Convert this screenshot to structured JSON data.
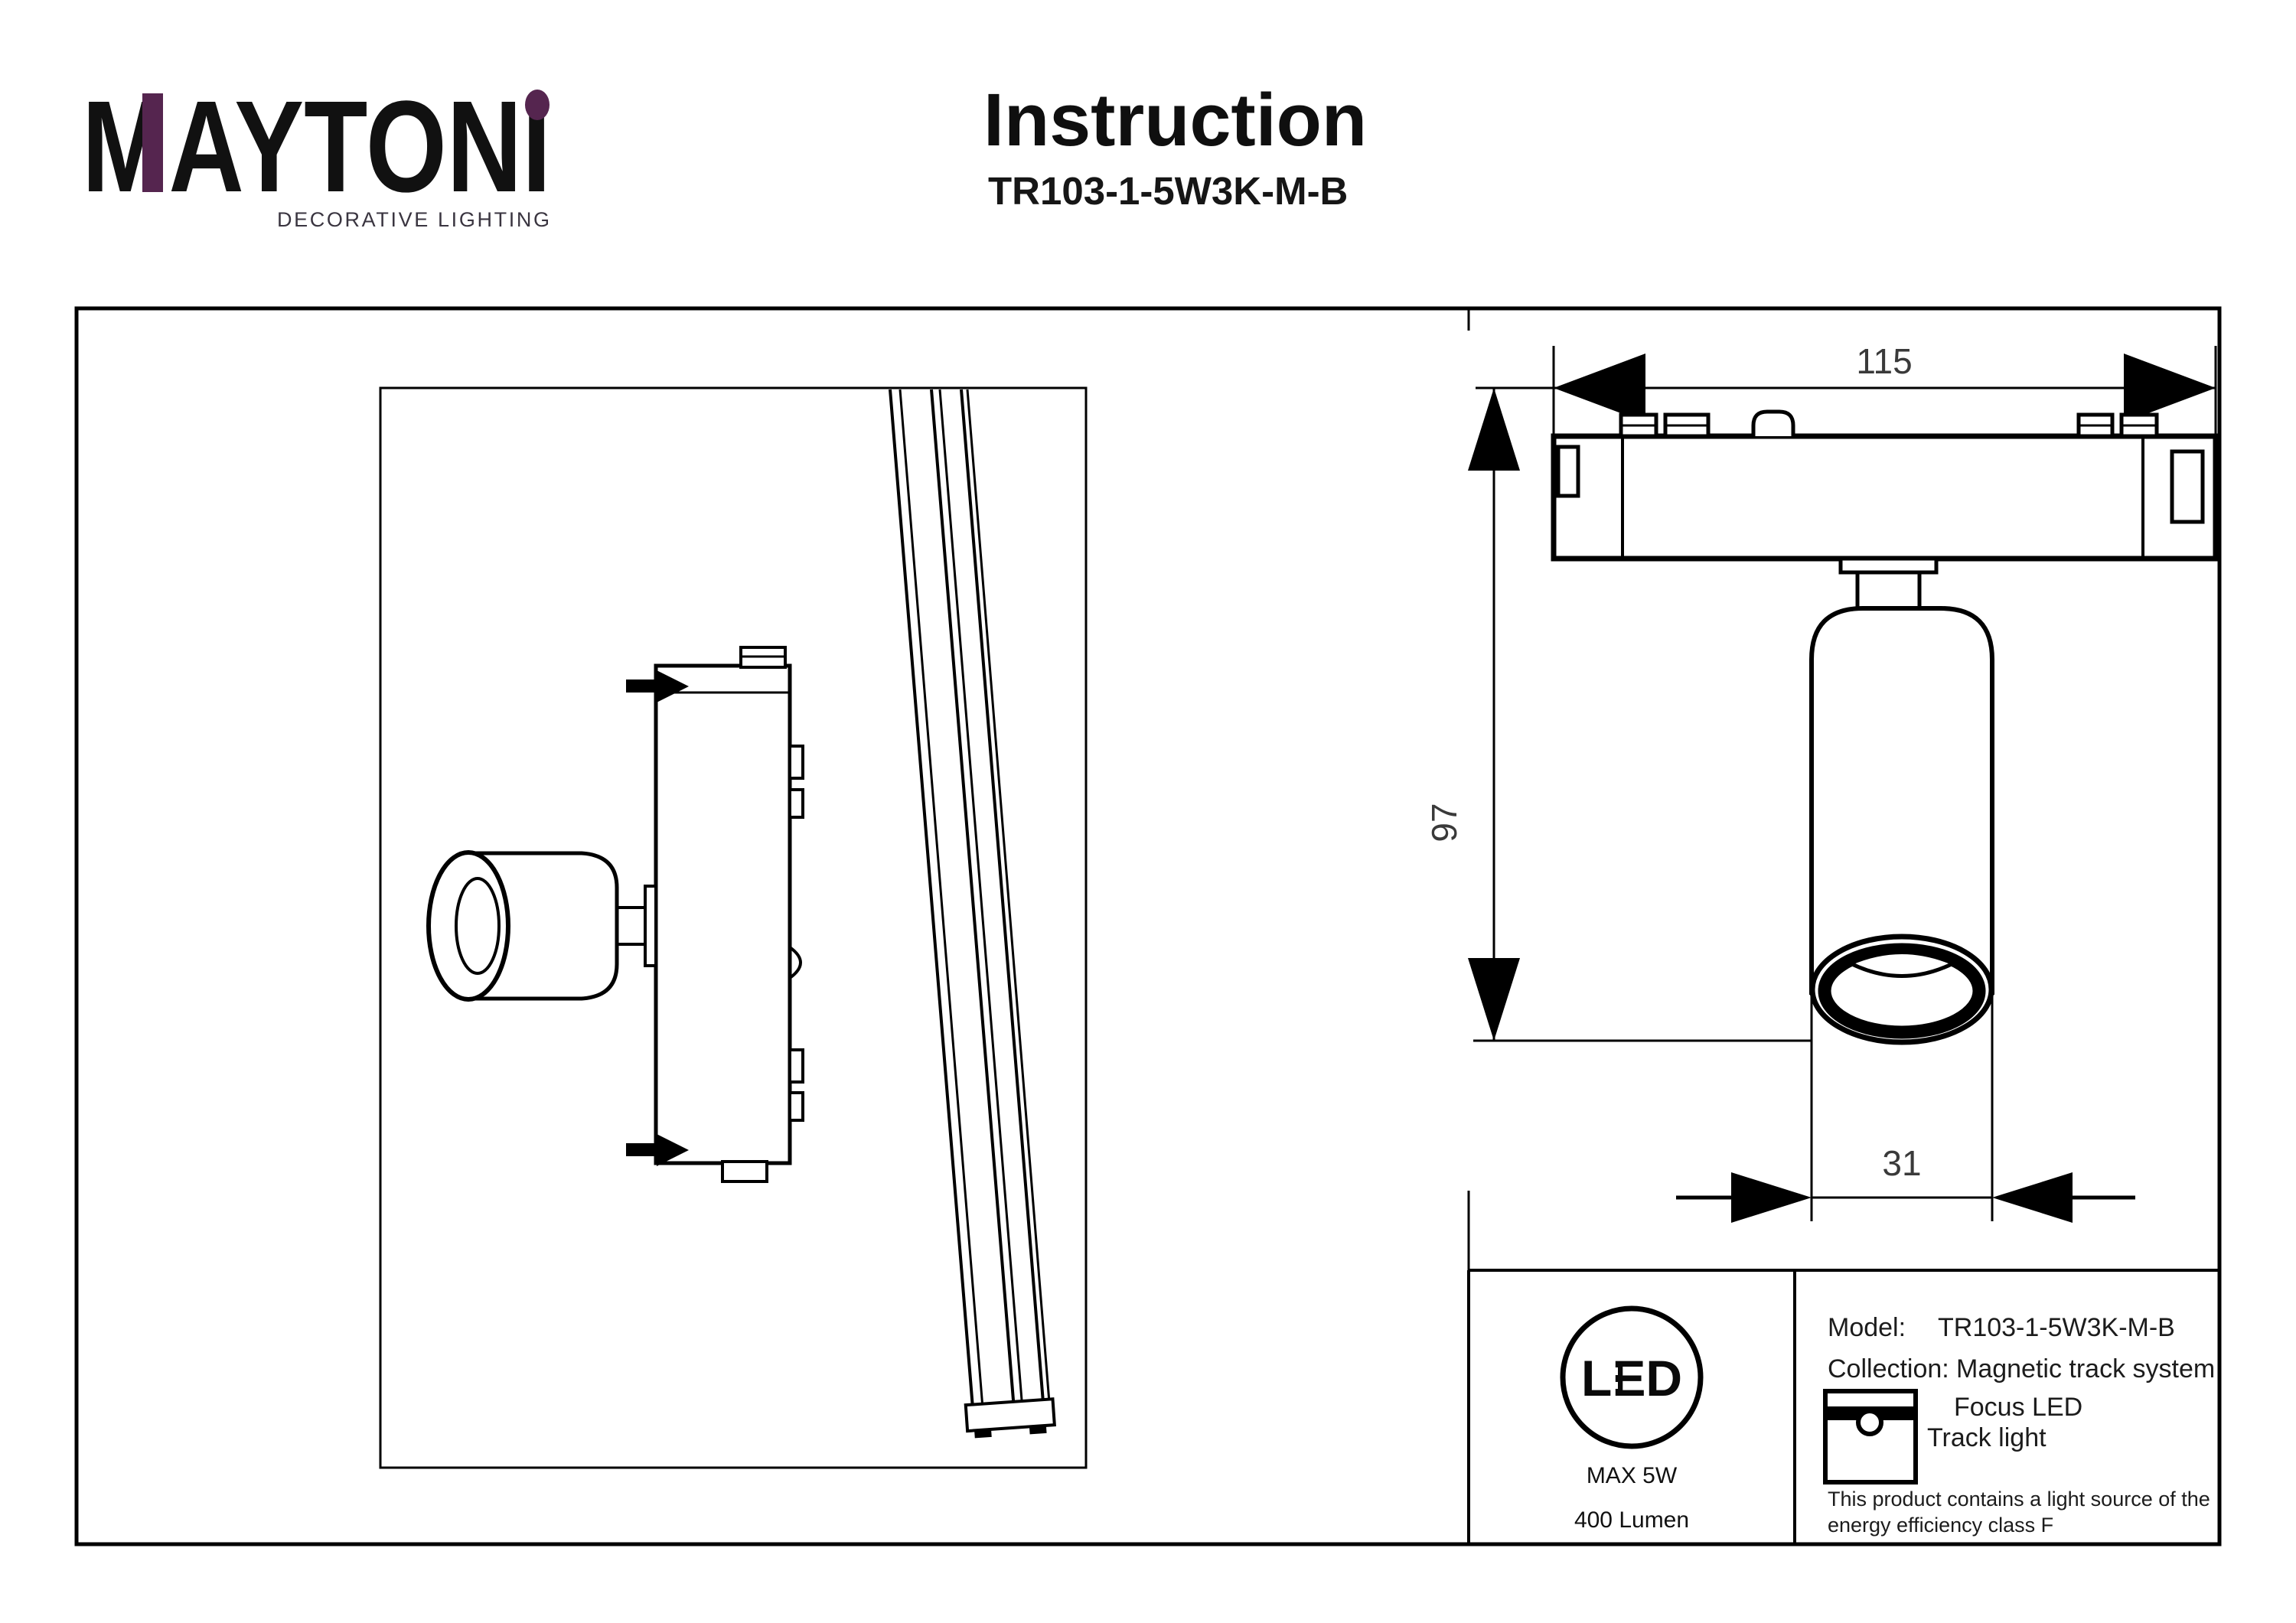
{
  "header": {
    "brand": "MAYTONI",
    "tagline": "DECORATIVE LIGHTING",
    "title": "Instruction",
    "subtitle": "TR103-1-5W3K-M-B"
  },
  "drawing": {
    "dim_width": "115",
    "dim_height": "97",
    "dim_diameter": "31"
  },
  "info": {
    "led_badge": {
      "text": "LED",
      "max_power": "MAX 5W",
      "luminous_flux": "400 Lumen"
    },
    "model_label": "Model:",
    "model_value": "TR103-1-5W3K-M-B",
    "collection_label": "Collection:",
    "collection_value": "Magnetic track system",
    "product_line1": "Focus LED",
    "product_line2": "Track light",
    "note_line1": "This product contains a light source of the",
    "note_line2": "energy efficiency class F"
  },
  "colors": {
    "accent": "#55254f",
    "line": "#000000"
  }
}
